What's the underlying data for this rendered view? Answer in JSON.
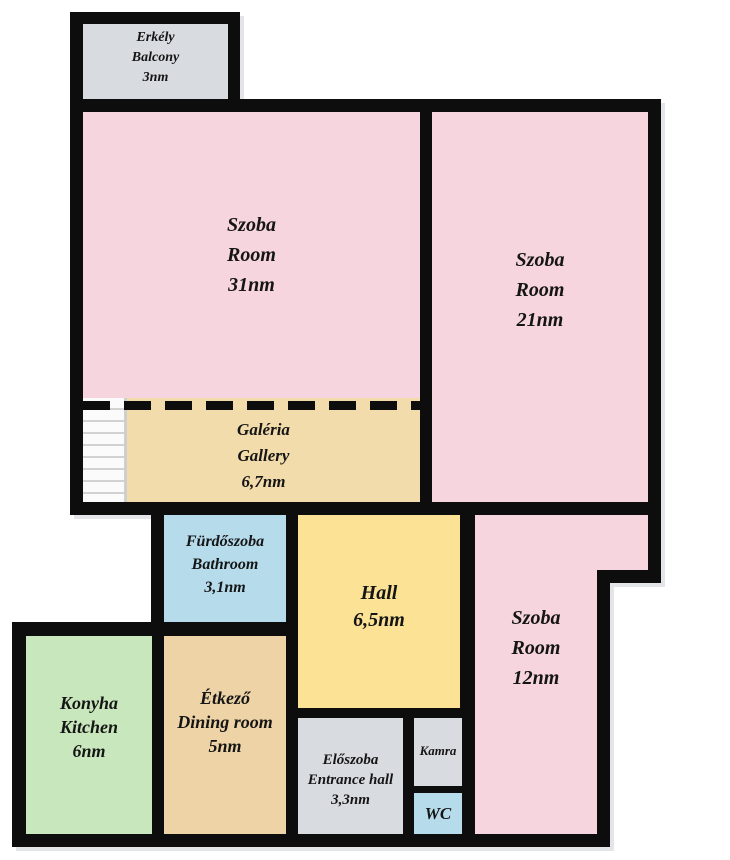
{
  "plan": {
    "type": "apartment-floor-plan",
    "colors": {
      "wall": "#0D0D0D",
      "room_pink": "#F6D5DE",
      "gallery_tan": "#F3DCAB",
      "dining_tan": "#EED3A6",
      "kitchen_green": "#C8E7BC",
      "bath_blue": "#B6DCEC",
      "hall_yellow": "#FBE294",
      "gray": "#D8DBE0",
      "shadow": "#E3E5E9",
      "stairs": "#FBFBFB"
    }
  },
  "rooms": {
    "balcony": {
      "lines": [
        "Erkély",
        "Balcony",
        "3nm"
      ]
    },
    "room31": {
      "lines": [
        "Szoba",
        "Room",
        "31nm"
      ]
    },
    "room21": {
      "lines": [
        "Szoba",
        "Room",
        "21nm"
      ]
    },
    "gallery": {
      "lines": [
        "Galéria",
        "Gallery",
        "6,7nm"
      ]
    },
    "bathroom": {
      "lines": [
        "Fürdőszoba",
        "Bathroom",
        "3,1nm"
      ]
    },
    "hall": {
      "lines": [
        "Hall",
        "6,5nm"
      ]
    },
    "room12": {
      "lines": [
        "Szoba",
        "Room",
        "12nm"
      ]
    },
    "kitchen": {
      "lines": [
        "Konyha",
        "Kitchen",
        "6nm"
      ]
    },
    "dining": {
      "lines": [
        "Étkező",
        "Dining room",
        "5nm"
      ]
    },
    "entrance": {
      "lines": [
        "Előszoba",
        "Entrance hall",
        "3,3nm"
      ]
    },
    "pantry": {
      "lines": [
        "Kamra"
      ]
    },
    "wc": {
      "lines": [
        "WC"
      ]
    }
  }
}
